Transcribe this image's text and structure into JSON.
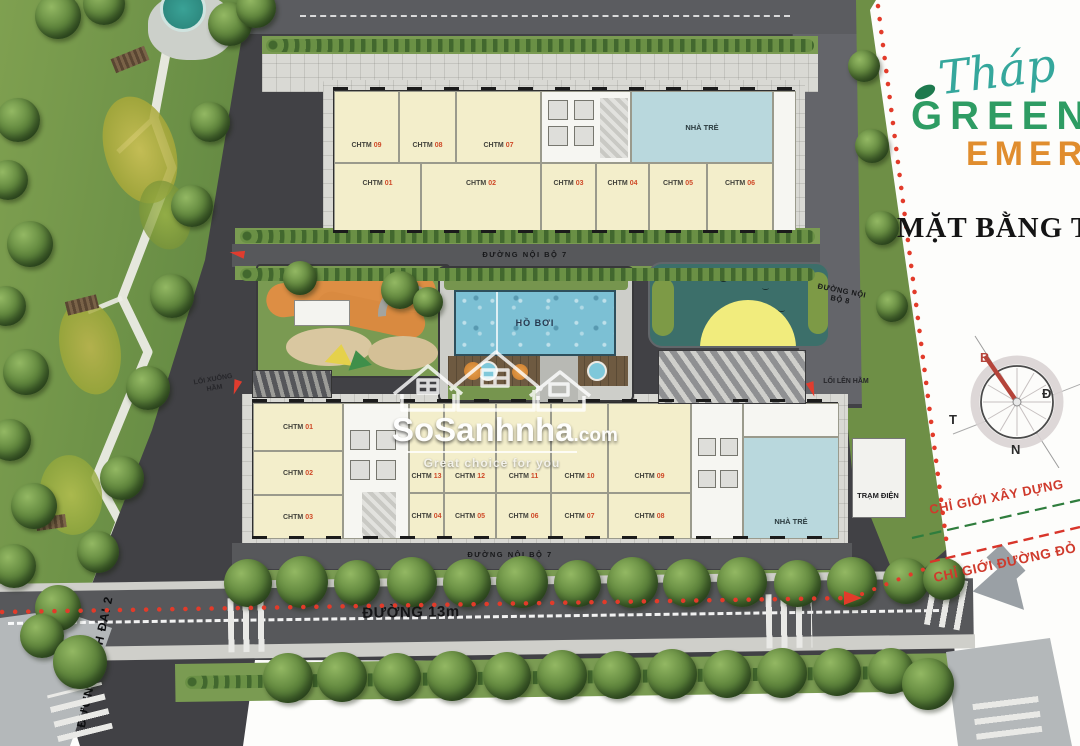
{
  "branding": {
    "script_word": "Tháp",
    "line1": "GREEN",
    "line2": "EMER",
    "subtitle": "MẶT BẰNG TỔ"
  },
  "compass": {
    "north": "B",
    "east": "Đ",
    "west": "T",
    "south": "N"
  },
  "boundary": {
    "construction_label": "CHỈ GIỚI XÂY DỰNG",
    "red_line_label": "CHỈ GIỚI ĐƯỜNG ĐỎ"
  },
  "roads": {
    "internal_7": "ĐƯỜNG NỘI BỘ 7",
    "internal_8": "ĐƯỜNG NỘI BỘ 8",
    "main_13m": "ĐƯỜNG 13m",
    "ring_road": "ĐƯỜNG VÀNH ĐAI 2"
  },
  "labels": {
    "power_station": "TRẠM ĐIỆN",
    "pool": "HỒ BƠI",
    "kindergarten": "NHÀ TRẺ",
    "basement_down": "LỐI XUỐNG HẦM",
    "basement_up": "LỐI LÊN HẦM"
  },
  "watermark": {
    "name": "SoSanhnha",
    "tld": ".com",
    "tagline": "Great choice for you"
  },
  "buildings": {
    "top": {
      "upper": [
        {
          "name": "CHTM",
          "num": "09"
        },
        {
          "name": "CHTM",
          "num": "08"
        },
        {
          "name": "CHTM",
          "num": "07"
        }
      ],
      "lower": [
        {
          "name": "CHTM",
          "num": "01"
        },
        {
          "name": "CHTM",
          "num": "02"
        },
        {
          "name": "CHTM",
          "num": "03"
        },
        {
          "name": "CHTM",
          "num": "04"
        },
        {
          "name": "CHTM",
          "num": "05"
        },
        {
          "name": "CHTM",
          "num": "06"
        }
      ]
    },
    "bottom": {
      "left": [
        {
          "name": "CHTM",
          "num": "01"
        },
        {
          "name": "CHTM",
          "num": "02"
        },
        {
          "name": "CHTM",
          "num": "03"
        }
      ],
      "upper": [
        {
          "name": "CHTM",
          "num": "13"
        },
        {
          "name": "CHTM",
          "num": "12"
        },
        {
          "name": "CHTM",
          "num": "11"
        },
        {
          "name": "CHTM",
          "num": "10"
        },
        {
          "name": "CHTM",
          "num": "09"
        }
      ],
      "lower": [
        {
          "name": "CHTM",
          "num": "04"
        },
        {
          "name": "CHTM",
          "num": "05"
        },
        {
          "name": "CHTM",
          "num": "06"
        },
        {
          "name": "CHTM",
          "num": "07"
        },
        {
          "name": "CHTM",
          "num": "08"
        }
      ]
    }
  },
  "colors": {
    "brand_teal": "#35a79c",
    "brand_green": "#2e9c63",
    "brand_orange": "#e8973a",
    "boundary_red": "#d8352a",
    "boundary_green": "#2f7d3d",
    "unit_number_red": "#cf4a28",
    "pool_blue": "#7cc0d4",
    "pond_teal": "#3c6f6a",
    "sun_yellow": "#f1ec7d"
  }
}
